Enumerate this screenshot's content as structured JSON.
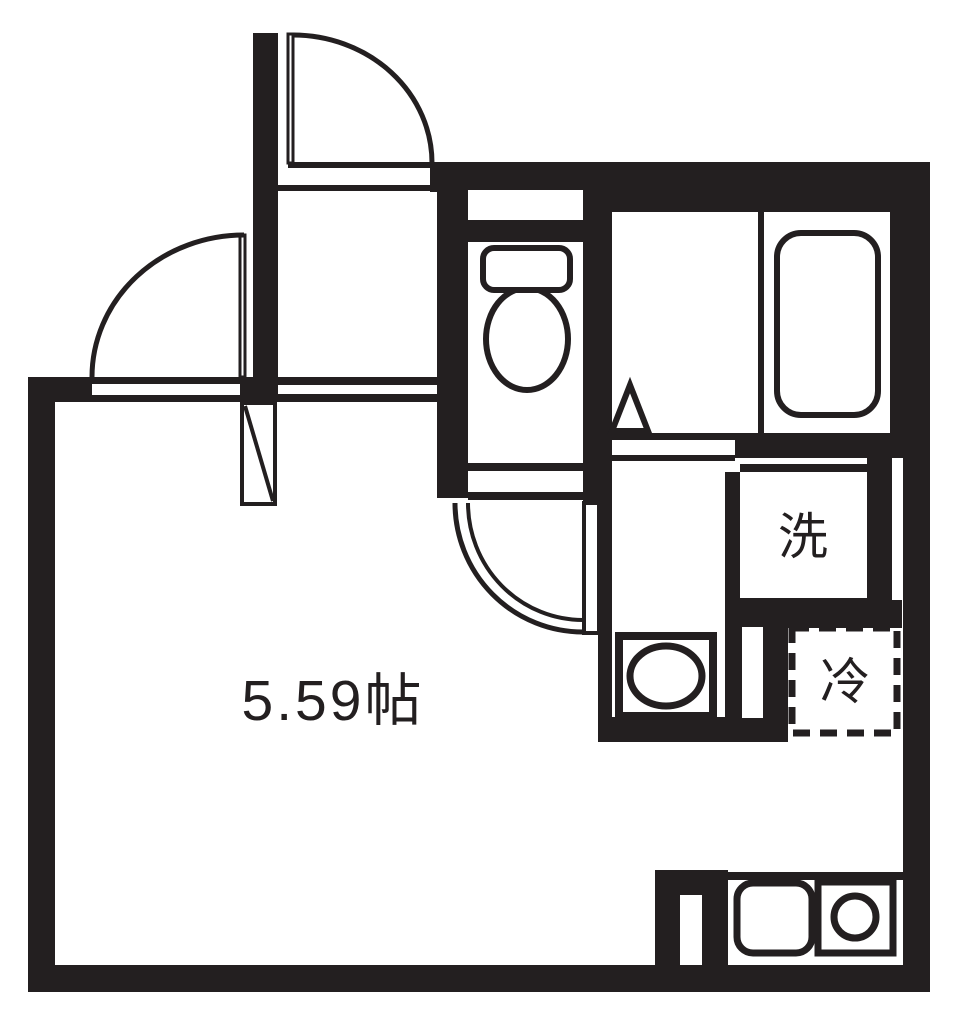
{
  "floorplan": {
    "labels": {
      "main_room_size": "5.59帖",
      "washing_machine": "洗",
      "refrigerator": "冷"
    },
    "colors": {
      "wall": "#231f20",
      "floor": "#ffffff"
    }
  }
}
